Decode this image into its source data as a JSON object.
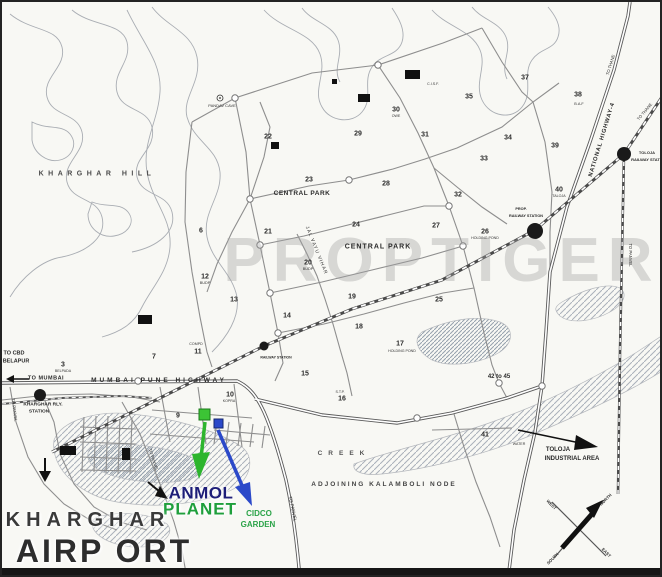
{
  "map": {
    "colors": {
      "anmol_navy": "#1d1d78",
      "planet_green": "#1f9f3c",
      "cidco_green": "#2ba348",
      "marker_green": "#3cc435",
      "marker_blue": "#2b49c9"
    },
    "labels": [
      {
        "n": "watermark",
        "t": "PROPTIGER",
        "x": 440,
        "y": 259,
        "s": 62,
        "w": 700,
        "ls": 8,
        "c": "rgba(160,160,160,0.38)"
      },
      {
        "n": "label-kharghar-hill",
        "t": "KHARGHAR HILL",
        "x": 95,
        "y": 172,
        "s": 7,
        "w": 600,
        "ls": 4.5,
        "c": "#4a4a4a"
      },
      {
        "n": "label-pandav-cave",
        "t": "PANDAV CAVE",
        "x": 220,
        "y": 104,
        "s": 4,
        "w": 400,
        "c": "#333333"
      },
      {
        "n": "label-central-park-1",
        "t": "CENTRAL PARK",
        "x": 300,
        "y": 192,
        "s": 6.5,
        "w": 700,
        "ls": 0.5
      },
      {
        "n": "label-central-park-2",
        "t": "CENTRAL PARK",
        "x": 376,
        "y": 245,
        "s": 7,
        "w": 700,
        "ls": 1
      },
      {
        "n": "label-jal-vayu-vihar",
        "t": "JAL VAYU VIHAR",
        "x": 313,
        "y": 249,
        "s": 4.8,
        "w": 400,
        "r": 68,
        "ls": 1,
        "c": "#333333"
      },
      {
        "n": "label-mumbai-pune-highway",
        "t": "MUMBAI  PUNE  HIGHWAY",
        "x": 157,
        "y": 379,
        "s": 6.5,
        "w": 700,
        "ls": 3
      },
      {
        "n": "label-to-mumbai",
        "t": "TO MUMBAI",
        "x": 44,
        "y": 377,
        "s": 5.5,
        "w": 700,
        "ls": 0.5
      },
      {
        "n": "label-to-cbd",
        "t": "TO CBD",
        "x": 12,
        "y": 352,
        "s": 5.5,
        "w": 700
      },
      {
        "n": "label-belapur",
        "t": "BELAPUR",
        "x": 14,
        "y": 360,
        "s": 5.5,
        "w": 700
      },
      {
        "n": "label-kharghar-rly-1",
        "t": "KHARGHAR RLY.",
        "x": 41,
        "y": 404,
        "s": 4.8,
        "w": 600
      },
      {
        "n": "label-kharghar-rly-2",
        "t": "STATION",
        "x": 37,
        "y": 411,
        "s": 4.8,
        "w": 600
      },
      {
        "n": "label-national-highway-4",
        "t": "NATIONAL HIGHWAY-4",
        "x": 601,
        "y": 138,
        "s": 5.8,
        "w": 600,
        "r": -73,
        "ls": 0.8
      },
      {
        "n": "label-to-thane-1",
        "t": "TO THANE",
        "x": 609,
        "y": 63,
        "s": 4.2,
        "w": 400,
        "r": -73
      },
      {
        "n": "label-to-thane-2",
        "t": "TO THANE",
        "x": 643,
        "y": 110,
        "s": 4.2,
        "w": 400,
        "r": -50
      },
      {
        "n": "label-toloja-rly-1",
        "t": "TOLOJA",
        "x": 645,
        "y": 151,
        "s": 4,
        "w": 600
      },
      {
        "n": "label-toloja-rly-2",
        "t": "RAILWAY STATION",
        "x": 647,
        "y": 158,
        "s": 4,
        "w": 600
      },
      {
        "n": "label-to-panvel-rail",
        "t": "TO PANVEL",
        "x": 628,
        "y": 253,
        "s": 4.2,
        "w": 400,
        "r": 90
      },
      {
        "n": "label-prop-rly-1",
        "t": "PROP.",
        "x": 519,
        "y": 208,
        "s": 3.8,
        "w": 600
      },
      {
        "n": "label-prop-rly-2",
        "t": "RAILWAY STATION",
        "x": 524,
        "y": 215,
        "s": 3.8,
        "w": 600
      },
      {
        "n": "label-railway-station-mid",
        "t": "RAILWAY STATION",
        "x": 274,
        "y": 356,
        "s": 3.5,
        "w": 600
      },
      {
        "n": "sector-3-label",
        "t": "3",
        "x": 61,
        "y": 363,
        "s": 7,
        "w": 700
      },
      {
        "n": "sector-3-sublabel",
        "t": "BELPADA",
        "x": 61,
        "y": 370,
        "s": 3.6,
        "w": 400,
        "c": "#333333"
      },
      {
        "n": "sector-6-label",
        "t": "6",
        "x": 199,
        "y": 229,
        "s": 7,
        "w": 700
      },
      {
        "n": "sector-7-label",
        "t": "7",
        "x": 152,
        "y": 355,
        "s": 7,
        "w": 700
      },
      {
        "n": "sector-9-label",
        "t": "9",
        "x": 176,
        "y": 414,
        "s": 7,
        "w": 700
      },
      {
        "n": "sector-10-label",
        "t": "10",
        "x": 228,
        "y": 393,
        "s": 7,
        "w": 700
      },
      {
        "n": "sector-10-sublabel",
        "t": "KOPRA",
        "x": 227,
        "y": 400,
        "s": 3.6,
        "w": 400,
        "c": "#333333"
      },
      {
        "n": "sector-11-sublabel",
        "t": "COMPD",
        "x": 194,
        "y": 343,
        "s": 3.6,
        "w": 400,
        "c": "#333333"
      },
      {
        "n": "sector-11-label",
        "t": "11",
        "x": 196,
        "y": 350,
        "s": 7,
        "w": 700
      },
      {
        "n": "sector-12-label",
        "t": "12",
        "x": 203,
        "y": 275,
        "s": 7,
        "w": 700
      },
      {
        "n": "sector-12-sublabel",
        "t": "BUDP",
        "x": 203,
        "y": 282,
        "s": 3.8,
        "w": 400,
        "c": "#333333"
      },
      {
        "n": "sector-13-label",
        "t": "13",
        "x": 232,
        "y": 298,
        "s": 7,
        "w": 700
      },
      {
        "n": "sector-14-label",
        "t": "14",
        "x": 285,
        "y": 314,
        "s": 7,
        "w": 700
      },
      {
        "n": "sector-15-label",
        "t": "15",
        "x": 303,
        "y": 372,
        "s": 7,
        "w": 700
      },
      {
        "n": "sector-16-sublabel",
        "t": "S.T.P.",
        "x": 338,
        "y": 391,
        "s": 3.6,
        "w": 400,
        "c": "#333333"
      },
      {
        "n": "sector-16-label",
        "t": "16",
        "x": 340,
        "y": 397,
        "s": 7,
        "w": 700
      },
      {
        "n": "sector-17-label",
        "t": "17",
        "x": 398,
        "y": 342,
        "s": 7,
        "w": 700
      },
      {
        "n": "sector-17-sublabel",
        "t": "HOLDING POND",
        "x": 400,
        "y": 350,
        "s": 3.6,
        "w": 400,
        "c": "#333333"
      },
      {
        "n": "sector-18-label",
        "t": "18",
        "x": 357,
        "y": 325,
        "s": 7,
        "w": 700
      },
      {
        "n": "sector-19-label",
        "t": "19",
        "x": 350,
        "y": 295,
        "s": 7,
        "w": 700
      },
      {
        "n": "sector-20-label",
        "t": "20",
        "x": 306,
        "y": 261,
        "s": 7,
        "w": 700
      },
      {
        "n": "sector-20-sublabel",
        "t": "BUDP",
        "x": 306,
        "y": 268,
        "s": 3.8,
        "w": 400,
        "c": "#333333"
      },
      {
        "n": "sector-21-label",
        "t": "21",
        "x": 266,
        "y": 230,
        "s": 7,
        "w": 700
      },
      {
        "n": "sector-22-label",
        "t": "22",
        "x": 266,
        "y": 135,
        "s": 7,
        "w": 700
      },
      {
        "n": "sector-23-label",
        "t": "23",
        "x": 307,
        "y": 178,
        "s": 7,
        "w": 700
      },
      {
        "n": "sector-24-label",
        "t": "24",
        "x": 354,
        "y": 223,
        "s": 7,
        "w": 700
      },
      {
        "n": "sector-25-label",
        "t": "25",
        "x": 437,
        "y": 298,
        "s": 7,
        "w": 700
      },
      {
        "n": "sector-26-label",
        "t": "26",
        "x": 483,
        "y": 230,
        "s": 7,
        "w": 700
      },
      {
        "n": "sector-26-sublabel",
        "t": "HOLDING POND",
        "x": 483,
        "y": 237,
        "s": 3.6,
        "w": 400,
        "c": "#333333"
      },
      {
        "n": "sector-27-label",
        "t": "27",
        "x": 434,
        "y": 224,
        "s": 7,
        "w": 700
      },
      {
        "n": "sector-28-label",
        "t": "28",
        "x": 384,
        "y": 182,
        "s": 7,
        "w": 700
      },
      {
        "n": "sector-29-label",
        "t": "29",
        "x": 356,
        "y": 132,
        "s": 7,
        "w": 700
      },
      {
        "n": "sector-30-label",
        "t": "30",
        "x": 394,
        "y": 108,
        "s": 7,
        "w": 700
      },
      {
        "n": "sector-30-sublabel",
        "t": "OWE",
        "x": 394,
        "y": 115,
        "s": 3.6,
        "w": 400,
        "c": "#333333"
      },
      {
        "n": "sector-31-label",
        "t": "31",
        "x": 423,
        "y": 133,
        "s": 7,
        "w": 700
      },
      {
        "n": "sector-32-label",
        "t": "32",
        "x": 456,
        "y": 193,
        "s": 7,
        "w": 700
      },
      {
        "n": "sector-33-label",
        "t": "33",
        "x": 482,
        "y": 157,
        "s": 7,
        "w": 700
      },
      {
        "n": "sector-34-label",
        "t": "34",
        "x": 506,
        "y": 136,
        "s": 7,
        "w": 700
      },
      {
        "n": "sector-35-label",
        "t": "35",
        "x": 467,
        "y": 95,
        "s": 7,
        "w": 700
      },
      {
        "n": "sector-37-label",
        "t": "37",
        "x": 523,
        "y": 76,
        "s": 7,
        "w": 700
      },
      {
        "n": "sector-38-label",
        "t": "38",
        "x": 576,
        "y": 93,
        "s": 7,
        "w": 700
      },
      {
        "n": "sector-38-sublabel",
        "t": "B.A.F",
        "x": 577,
        "y": 103,
        "s": 3.8,
        "w": 400,
        "c": "#333333"
      },
      {
        "n": "sector-39-label",
        "t": "39",
        "x": 553,
        "y": 144,
        "s": 7,
        "w": 700
      },
      {
        "n": "sector-40-label",
        "t": "40",
        "x": 557,
        "y": 188,
        "s": 7,
        "w": 700
      },
      {
        "n": "sector-40-sublabel",
        "t": "TALOJA",
        "x": 557,
        "y": 195,
        "s": 3.6,
        "w": 400,
        "c": "#333333"
      },
      {
        "n": "sector-41-label",
        "t": "41",
        "x": 483,
        "y": 433,
        "s": 7,
        "w": 700
      },
      {
        "n": "sector-42-45-label",
        "t": "42 to 45",
        "x": 497,
        "y": 375,
        "s": 6,
        "w": 700
      },
      {
        "n": "label-cisf",
        "t": "C.I.S.F.",
        "x": 431,
        "y": 83,
        "s": 3.6,
        "w": 400,
        "c": "#333333"
      },
      {
        "n": "label-water",
        "t": "WATER",
        "x": 517,
        "y": 443,
        "s": 3.6,
        "w": 400,
        "c": "#333333"
      },
      {
        "n": "label-creek",
        "t": "CREEK",
        "x": 342,
        "y": 452,
        "s": 6.5,
        "w": 600,
        "ls": 6,
        "c": "#555555"
      },
      {
        "n": "label-adjoining-kalamboli",
        "t": "ADJOINING  KALAMBOLI  NODE",
        "x": 382,
        "y": 483,
        "s": 6.5,
        "w": 600,
        "ls": 2,
        "c": "#444444"
      },
      {
        "n": "label-toloja-industrial-1",
        "t": "TOLOJA",
        "x": 556,
        "y": 448,
        "s": 6,
        "w": 600
      },
      {
        "n": "label-toloja-industrial-2",
        "t": "INDUSTRIAL AREA",
        "x": 570,
        "y": 457,
        "s": 6,
        "w": 600
      },
      {
        "n": "label-to-panvel-left",
        "t": "TO PANVEL",
        "x": 12,
        "y": 408,
        "s": 4.2,
        "w": 400,
        "r": 83
      },
      {
        "n": "label-to-panvel-mid",
        "t": "TO PANVEL",
        "x": 151,
        "y": 458,
        "s": 4.2,
        "w": 400,
        "r": 72
      },
      {
        "n": "label-to-panvel-main",
        "t": "TO PANVEL",
        "x": 290,
        "y": 507,
        "s": 4.6,
        "w": 400,
        "r": 78
      },
      {
        "n": "brand-anmol",
        "t": "ANMOL",
        "x": 199,
        "y": 491,
        "s": 17,
        "w": 800,
        "c": "#1d1d78",
        "ls": 0.5
      },
      {
        "n": "brand-planet",
        "t": "PLANET",
        "x": 198,
        "y": 507,
        "s": 17,
        "w": 800,
        "c": "#1f9f3c",
        "ls": 1
      },
      {
        "n": "label-cidco-garden-1",
        "t": "CIDCO",
        "x": 257,
        "y": 512,
        "s": 8,
        "w": 700,
        "c": "#2ba348"
      },
      {
        "n": "label-cidco-garden-2",
        "t": "GARDEN",
        "x": 256,
        "y": 523,
        "s": 8,
        "w": 700,
        "c": "#2ba348"
      },
      {
        "n": "map-title-kharghar",
        "t": "KHARGHAR",
        "x": 86,
        "y": 518,
        "s": 20,
        "w": 600,
        "ls": 6,
        "c": "#3a3a3a"
      },
      {
        "n": "map-title-airport",
        "t": "AIRP ORT",
        "x": 102,
        "y": 549,
        "s": 32,
        "w": 600,
        "ls": 3,
        "c": "#2d2d2d"
      },
      {
        "n": "compass-north-label",
        "t": "NORTH",
        "x": 604,
        "y": 498,
        "s": 4.2,
        "w": 600,
        "r": -45,
        "c": "#333333"
      },
      {
        "n": "compass-west-label",
        "t": "WEST",
        "x": 549,
        "y": 503,
        "s": 4.2,
        "w": 600,
        "r": 45,
        "c": "#333333"
      },
      {
        "n": "compass-south-label",
        "t": "SOUTH",
        "x": 551,
        "y": 557,
        "s": 4.2,
        "w": 600,
        "r": -45,
        "c": "#333333"
      },
      {
        "n": "compass-east-label",
        "t": "EAST",
        "x": 604,
        "y": 551,
        "s": 4.2,
        "w": 600,
        "r": 45,
        "c": "#333333"
      }
    ]
  }
}
